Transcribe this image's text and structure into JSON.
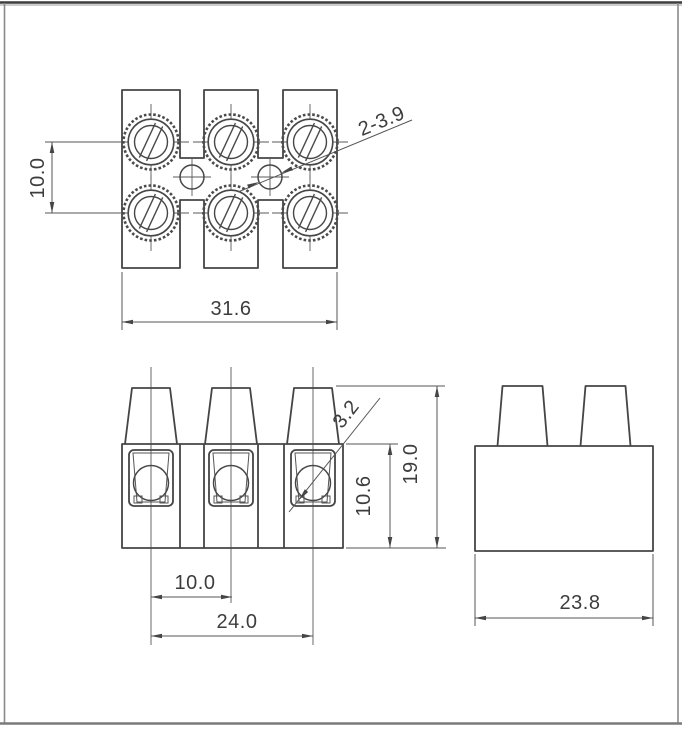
{
  "meta": {
    "drawing_type": "terminal-block dimensional drawing, three views",
    "units": "mm"
  },
  "colors": {
    "background": "#ffffff",
    "line": "#4a4a4a",
    "text": "#3d3d3d",
    "frame_top": "#3c3c3c",
    "frame_side": "#8a8a8a"
  },
  "top_view": {
    "dim_row_pitch": "10.0",
    "dim_overall_width": "31.6",
    "callout_mounting_holes": "2-3.9"
  },
  "front_view": {
    "callout_wire_hole": "3.2",
    "dim_body_height": "10.6",
    "dim_overall_height": "19.0",
    "dim_pole_pitch": "10.0",
    "dim_pole_span": "24.0"
  },
  "side_view": {
    "dim_depth": "23.8"
  }
}
